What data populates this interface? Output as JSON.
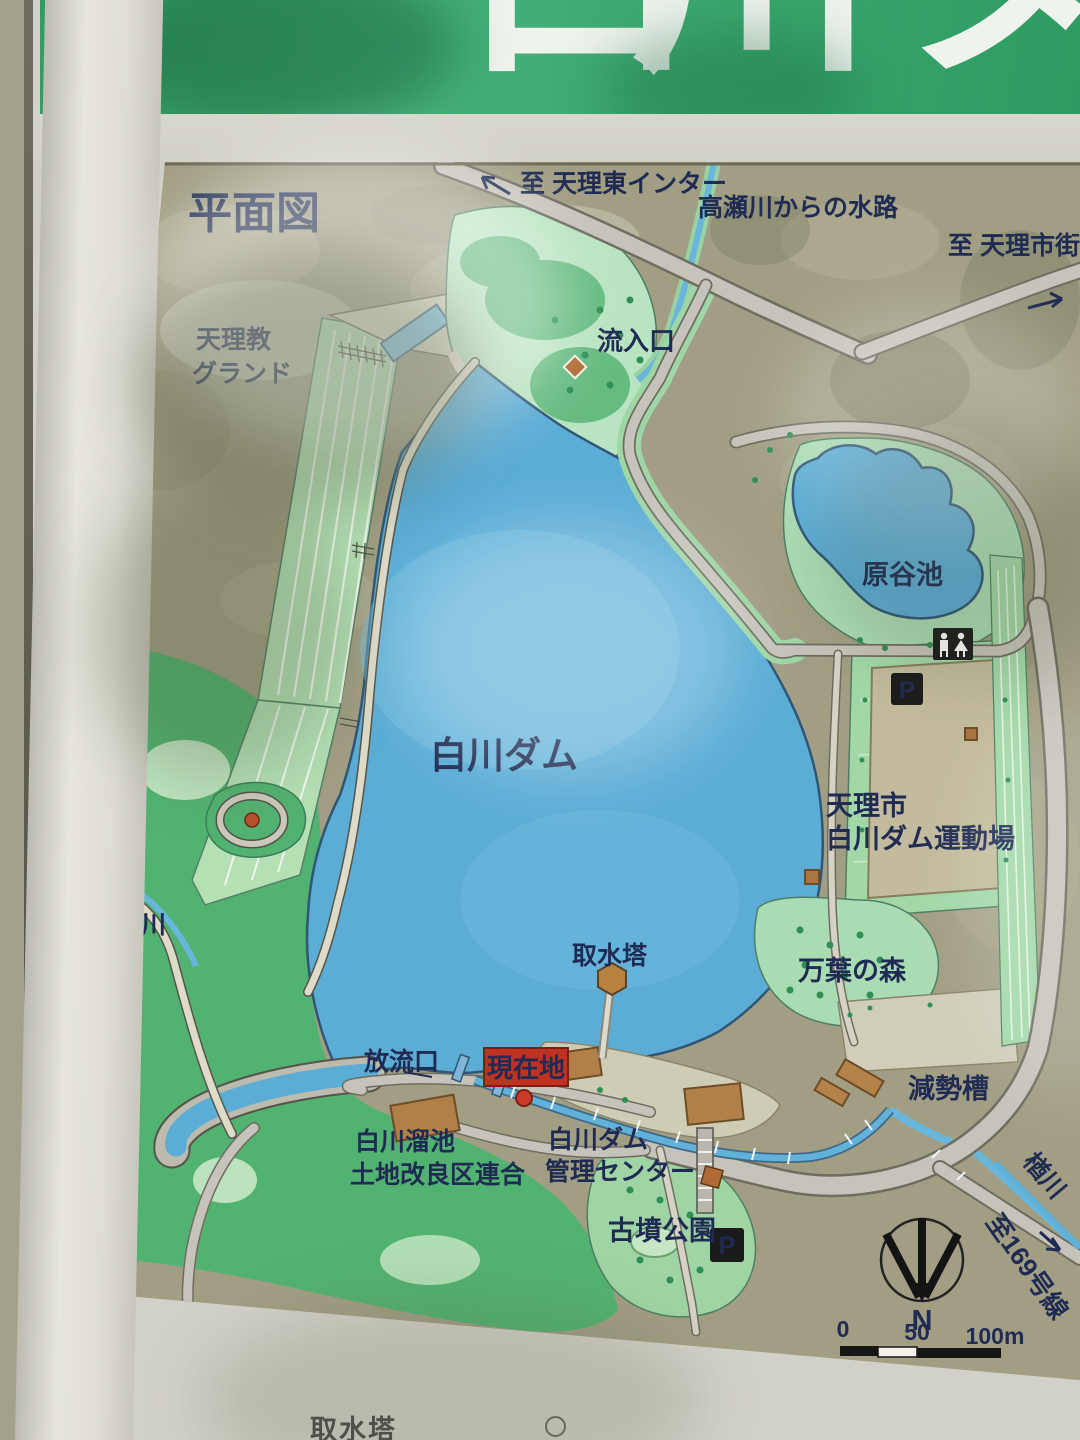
{
  "banner": {
    "chars": [
      "白",
      "川",
      "ダ"
    ],
    "bg_color": "#37a56b"
  },
  "map": {
    "title": "平面図",
    "labels": {
      "to_tenri_higashi": "至 天理東インター",
      "takase_channel": "高瀬川からの水路",
      "to_tenri_city": "至 天理市街",
      "tenrikyo_ground_line1": "天理教",
      "tenrikyo_ground_line2": "グランド",
      "inflow": "流入口",
      "lake_name": "白川ダム",
      "haratani_pond": "原谷池",
      "sports_ground_line1": "天理市",
      "sports_ground_line2": "白川ダム運動場",
      "narakawa_west": "楢川",
      "intake_tower": "取水塔",
      "manyo_forest": "万葉の森",
      "outlet": "放流口",
      "you_are_here": "現在地",
      "reservoir_union_line1": "白川溜池",
      "reservoir_union_line2": "土地改良区連合",
      "management_center_line1": "白川ダム",
      "management_center_line2": "管理センター",
      "kofun_park": "古墳公園",
      "stilling_basin": "減勢槽",
      "narakawa_east": "楢川",
      "to_route_169": "至169号線"
    },
    "icons": {
      "parking": "P",
      "toilet": "toilet-pictogram",
      "north": "N"
    },
    "scale_bar": {
      "tick_0": "0",
      "tick_50": "50",
      "tick_100": "100m"
    },
    "legend_partial": "取水塔",
    "colors": {
      "lake_blue": "#5badd6",
      "park_green": "#52b271",
      "light_green": "#aadcb0",
      "panel_khaki": "#a19e83",
      "road_grey": "#c9c6ba",
      "building_brown": "#b08048",
      "marker_red": "#bf3222",
      "label_navy": "#1f2b52"
    }
  }
}
